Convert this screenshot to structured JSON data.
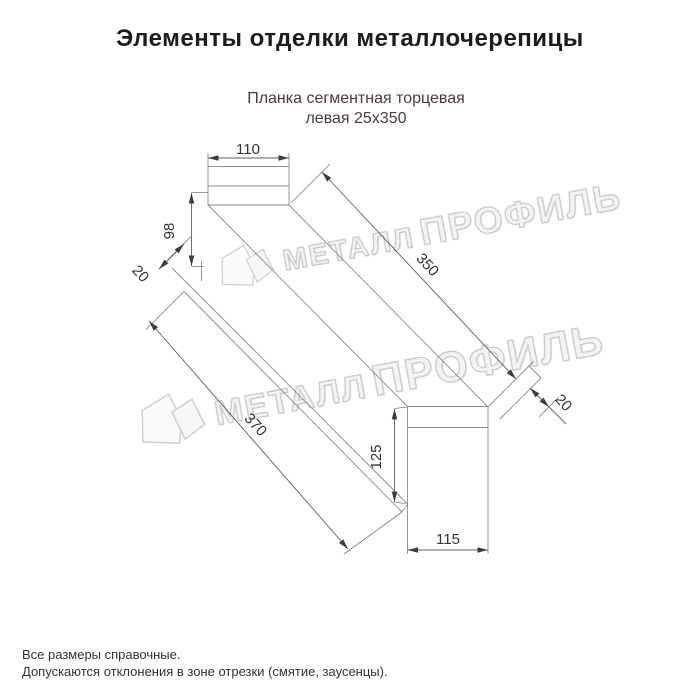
{
  "header": {
    "title": "Элементы отделки металлочерепицы"
  },
  "product": {
    "title_line1": "Планка сегментная торцевая",
    "title_line2": "левая 25х350"
  },
  "drawing": {
    "dim_top_width": "110",
    "dim_face_height": "98",
    "dim_left_fold": "20",
    "dim_length_top": "350",
    "dim_length_bottom": "370",
    "dim_right_fold": "20",
    "dim_front_height": "125",
    "dim_front_width": "115"
  },
  "watermark": {
    "word1": "МЕТАЛЛ",
    "word2": "ПРОФИЛЬ"
  },
  "footer": {
    "note1": "Все размеры справочные.",
    "note2": "Допускаются отклонения в зоне отрезки (смятие, заусенцы)."
  },
  "colors": {
    "title": "#1c1c1c",
    "subtitle": "#4a3c35",
    "geometry_line": "#8b8b8b",
    "dimension_line": "#5e5e5e",
    "dimension_text": "#333333",
    "watermark": "#d9d9d9",
    "background": "#ffffff"
  }
}
